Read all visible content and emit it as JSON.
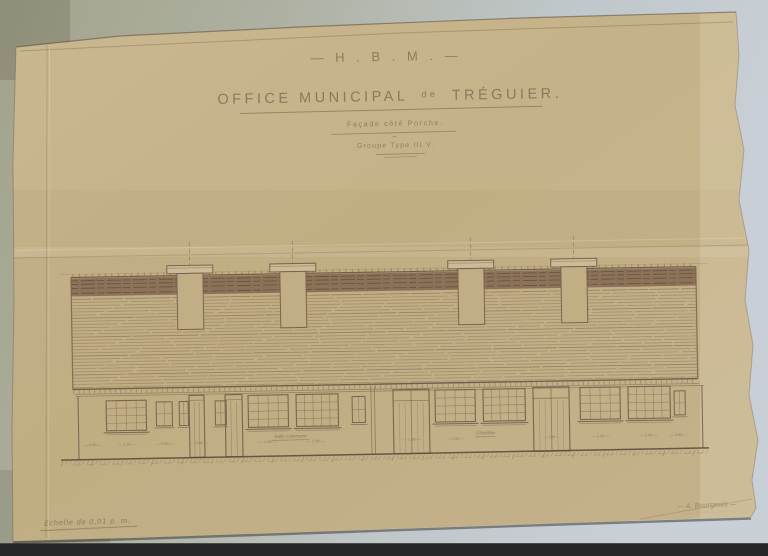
{
  "scene": {
    "width": 768,
    "height": 556
  },
  "colors": {
    "bg_left": "#a4a48c",
    "bg_right": "#c7ced5",
    "table_strip": "#26262a",
    "paper": "#c2ae84",
    "paper_light": "#cdbb97",
    "pencil": "#7a6450",
    "pencil_dark": "#5f4d3b",
    "roof_band": "#7b614b",
    "ink_title": "#8a755b"
  },
  "titles": {
    "series": "—   H . B . M .   —",
    "office_left": "OFFICE  MUNICIPAL",
    "office_de": "de",
    "office_right": "TRÉGUIER.",
    "facade": "Façade  côté  Porche.",
    "group": "Groupe  Type  III.V."
  },
  "notes": {
    "scale": "Echelle de 0,01 p. m.",
    "signature_line1": "— A. Bourgeois —",
    "signature_line2": "Architecte  D.P.L.G.",
    "signature_line3": "Avril 1930."
  },
  "drawing": {
    "roof": {
      "left": 71,
      "right": 696,
      "guide_y": 269,
      "ridge_y": 272,
      "band_top": 273,
      "band_bottom": 291,
      "eave_y": 384,
      "fascia_y": 389,
      "course_start": 294,
      "course_step": 3.15,
      "course_count": 29
    },
    "chimneys": [
      {
        "cx": 190
      },
      {
        "cx": 293
      },
      {
        "cx": 471
      },
      {
        "cx": 574
      }
    ],
    "chimney_style": {
      "cap_w": 46,
      "cap_h": 8,
      "cap_y": 262,
      "shaft_w": 26,
      "shaft_top": 270,
      "shaft_bottom": 326,
      "dash_top": 239
    },
    "facade": {
      "top": 391,
      "ground": 454,
      "left": 76,
      "right": 700,
      "large_windows": [
        {
          "x": 104,
          "y": 396,
          "w": 40,
          "h": 30,
          "cols": 4,
          "rows": 4
        },
        {
          "x": 246,
          "y": 393,
          "w": 40,
          "h": 32,
          "cols": 4,
          "rows": 4
        },
        {
          "x": 294,
          "y": 393,
          "w": 42,
          "h": 32,
          "cols": 5,
          "rows": 4
        },
        {
          "x": 433,
          "y": 391,
          "w": 40,
          "h": 32,
          "cols": 4,
          "rows": 4
        },
        {
          "x": 481,
          "y": 391,
          "w": 42,
          "h": 32,
          "cols": 5,
          "rows": 4
        },
        {
          "x": 578,
          "y": 391,
          "w": 40,
          "h": 32,
          "cols": 4,
          "rows": 4
        },
        {
          "x": 626,
          "y": 391,
          "w": 42,
          "h": 32,
          "cols": 5,
          "rows": 4
        }
      ],
      "small_windows": [
        {
          "x": 154,
          "y": 398,
          "w": 16,
          "h": 24
        },
        {
          "x": 177,
          "y": 398,
          "w": 9,
          "h": 24
        },
        {
          "x": 213,
          "y": 398,
          "w": 11,
          "h": 24
        },
        {
          "x": 350,
          "y": 396,
          "w": 13,
          "h": 26
        },
        {
          "x": 672,
          "y": 396,
          "w": 11,
          "h": 24
        }
      ],
      "doors": [
        {
          "x": 187,
          "w": 15
        },
        {
          "x": 223,
          "w": 17
        }
      ],
      "wide_doors": [
        {
          "x": 391,
          "w": 36
        },
        {
          "x": 531,
          "w": 36
        }
      ],
      "downpipes": [
        369
      ],
      "labels": [
        {
          "x": 288,
          "y": 436,
          "text": "Salle Commune"
        },
        {
          "x": 483,
          "y": 436,
          "text": "Chambre"
        }
      ],
      "dims": [
        {
          "x": 90,
          "text": "0.45"
        },
        {
          "x": 124,
          "text": "1.30"
        },
        {
          "x": 162,
          "text": "0.80"
        },
        {
          "x": 196,
          "text": "0.90"
        },
        {
          "x": 265,
          "text": "1.50"
        },
        {
          "x": 313,
          "text": "1.50"
        },
        {
          "x": 409,
          "text": "1.80"
        },
        {
          "x": 453,
          "text": "1.50"
        },
        {
          "x": 549,
          "text": "1.80"
        },
        {
          "x": 598,
          "text": "1.50"
        },
        {
          "x": 646,
          "text": "1.50"
        },
        {
          "x": 676,
          "text": "0.60"
        }
      ]
    }
  }
}
